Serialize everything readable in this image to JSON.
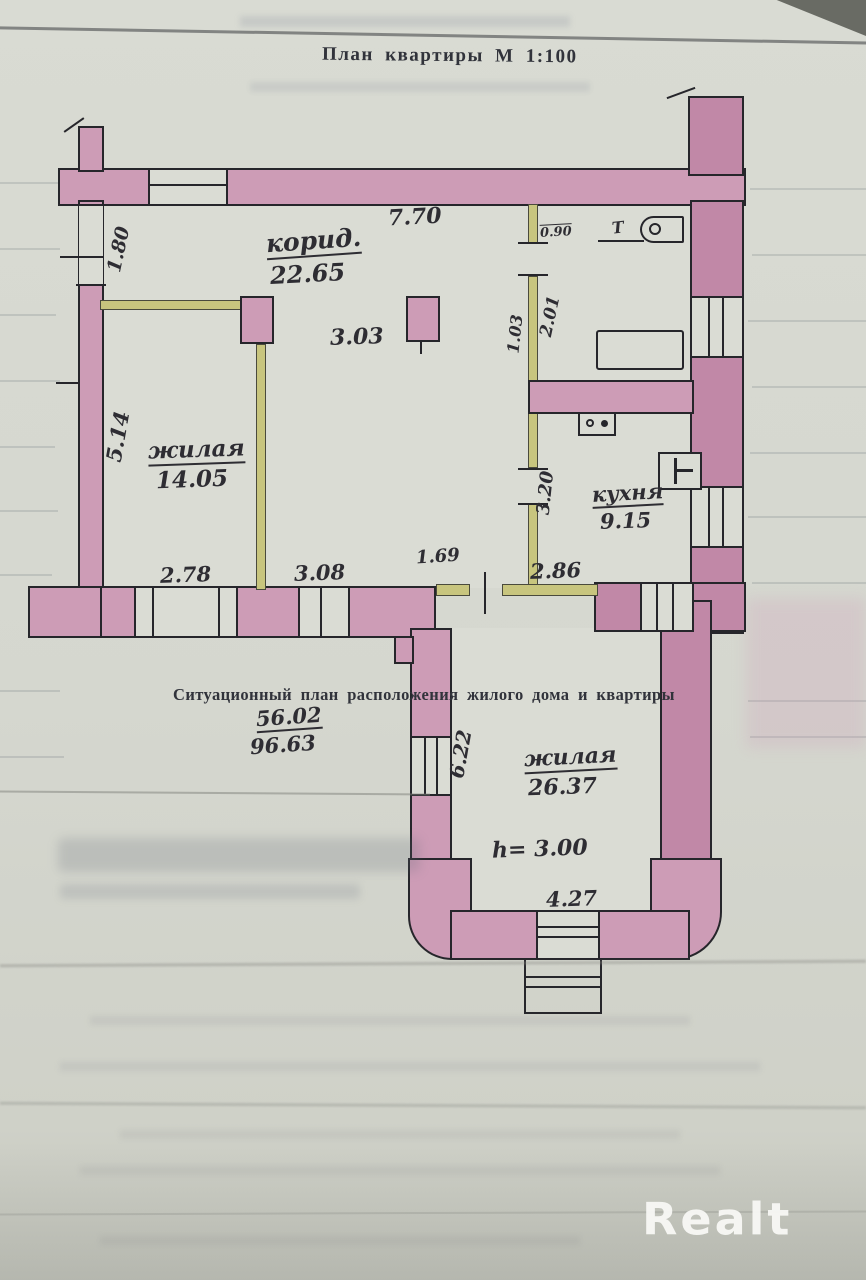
{
  "page": {
    "title": "План квартиры М 1:100",
    "watermark": "Realt"
  },
  "plan": {
    "heading": "Ситуационный план расположения жилого дома и квартиры",
    "area_fraction": {
      "top": "56.02",
      "bottom": "96.63"
    },
    "rooms": [
      {
        "name": "корид.",
        "area": "22.65"
      },
      {
        "name": "жилая",
        "area": "14.05"
      },
      {
        "name": "кухня",
        "area": "9.15"
      },
      {
        "name": "жилая",
        "area": "26.37"
      }
    ],
    "labels": {
      "corridor_width": "3.03",
      "height_note": "h= 3.00",
      "toilet": "Т",
      "bath_door": "0.90"
    },
    "dims": {
      "top": "7.70",
      "left_opening": "1.80",
      "left_room_height": "5.14",
      "bath_left": "1.03",
      "bath_width": "2.01",
      "kitchen_left": "3.20",
      "bottom_a": "2.78",
      "bottom_b": "3.08",
      "bottom_c": "1.69",
      "bottom_d": "2.86",
      "lower_left": "6.22",
      "lower_bottom": "4.27"
    },
    "colors": {
      "wall": "#cd9cb6",
      "wall2": "#c188a7",
      "partition": "#c8c57e",
      "room": "#dadcd4",
      "paper": "#d5d7cf",
      "ink": "#2e2d33",
      "outline": "#26262b"
    }
  }
}
